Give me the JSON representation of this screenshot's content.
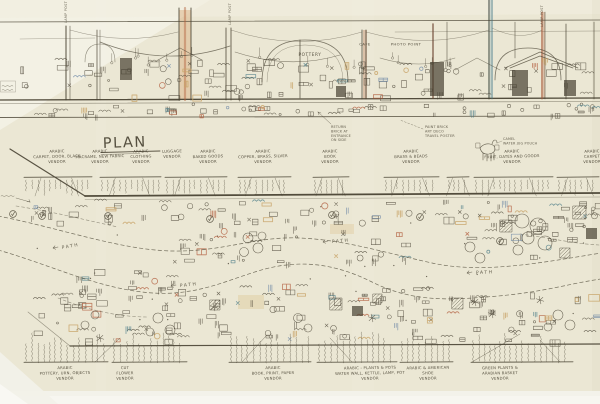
{
  "document": {
    "kind": "hand-drawn market concept sketch",
    "view_top": "elevation of souk market street",
    "view_bottom": "plan of vendor stalls and winding path"
  },
  "plan": {
    "title": "PLAN",
    "path_label": "PATH",
    "path_label_count": 4
  },
  "elevation": {
    "labels": {
      "pottery": "POTTERY",
      "cafe": "CAFE",
      "photo_point": "PHOTO POINT"
    },
    "lamp_post_label": "LAMP POST",
    "notes": {
      "entrance": [
        "RETURN",
        "BRICK AT",
        "ENTRANCE",
        "ON SIDE"
      ],
      "finish": [
        "PAINT BRICK",
        "ART DECO",
        "TRAVEL POSTER"
      ],
      "camel": [
        "CAMEL",
        "WATER JUG POUCH"
      ]
    }
  },
  "vendors_top": [
    {
      "lines": [
        "ARABIC",
        "CARPET, DOOR, BLACK",
        "VENDOR"
      ]
    },
    {
      "lines": [
        "ARABIC",
        "MACRAME, NEW FABRIC",
        "VENDOR"
      ]
    },
    {
      "lines": [
        "ARABIC",
        "CLOTHING",
        "VENDOR"
      ]
    },
    {
      "lines": [
        "LUGGAGE",
        "VENDOR"
      ]
    },
    {
      "lines": [
        "ARABIC",
        "BAKED GOODS",
        "VENDOR"
      ]
    },
    {
      "lines": [
        "ARABIC",
        "COPPER, BRASS, SILVER",
        "VENDOR"
      ]
    },
    {
      "lines": [
        "ARABIC",
        "BOOK",
        "VENDOR"
      ]
    },
    {
      "lines": [
        "ARABIC",
        "BRASS & BEADS",
        "VENDOR"
      ]
    },
    {
      "lines": [
        "ARABIC",
        "FRUIT, DATES AND GOODS",
        "VENDOR"
      ]
    },
    {
      "lines": [
        "ARABIC",
        "CARPET",
        "VENDOR"
      ]
    }
  ],
  "vendors_bottom": [
    {
      "lines": [
        "ARABIC",
        "POTTERY, URN, OBJECTS",
        "VENDOR"
      ]
    },
    {
      "lines": [
        "CUT",
        "FLOWER",
        "VENDOR"
      ]
    },
    {
      "lines": [
        "ARABIC",
        "BOOK, PRINT, PAPER",
        "VENDOR"
      ]
    },
    {
      "lines": [
        "ARABIC - PLANTS & POTS",
        "WATER WALL, KETTLE, LAMP, POT",
        "VENDOR"
      ]
    },
    {
      "lines": [
        "ARABIC & AMERICAN",
        "SHOE",
        "VENDOR"
      ]
    },
    {
      "lines": [
        "GREEN PLANTS &",
        "ARABIAN BASKET",
        "VENDOR"
      ]
    }
  ],
  "palette": {
    "paper": "#ebe7d4",
    "paper_light": "#f6f4e9",
    "ink": "#4a4434",
    "accent_red": "#b05a3a",
    "accent_teal": "#4e7d88",
    "accent_tan": "#c8a468",
    "accent_blue": "#5d7ba0"
  }
}
